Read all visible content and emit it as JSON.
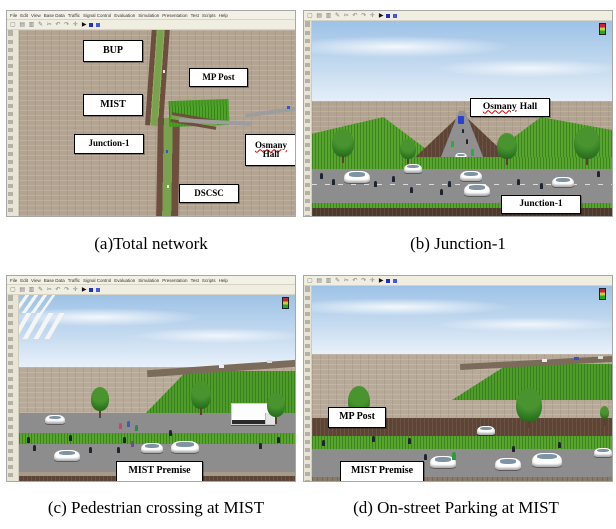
{
  "captions": {
    "a": "(a)Total network",
    "b": "(b) Junction-1",
    "c": "(c) Pedestrian crossing at MIST",
    "d": "(d) On-street Parking at MIST"
  },
  "menu_items": [
    "File",
    "Edit",
    "View",
    "Base Data",
    "Traffic",
    "Signal Control",
    "Evaluation",
    "Simulation",
    "Presentation",
    "Test",
    "Scripts",
    "Help"
  ],
  "toolbar": {
    "icons": "▢ ▤ ▥ ✎ ✂ ↶ ↷ ✛",
    "play": "▶"
  },
  "labels": {
    "a_bup": "BUP",
    "a_mp_post": "MP Post",
    "a_mist": "MIST",
    "a_junction1": "Junction-1",
    "a_osmany": "Osmany",
    "a_hall": "Hall",
    "b_osmany": "Osmany",
    "b_hall": "Hall",
    "b_junction1": "Junction-1",
    "a_dscsc": "DSCSC",
    "c_mist_premise": "MIST Premise",
    "d_mp_post": "MP Post",
    "d_mist_premise": "MIST Premise"
  },
  "colors": {
    "sky": "#9dc2e6",
    "ground_tan": "#b3a492",
    "grass": "#57a42f",
    "dirt_brown": "#5e4434",
    "road_gray": "#8d8d8d",
    "road_edge_brown": "#6e4e3e",
    "median_green": "#7aa24e",
    "play_button_blue": "#1f2fbf",
    "label_background": "#ffffff"
  }
}
